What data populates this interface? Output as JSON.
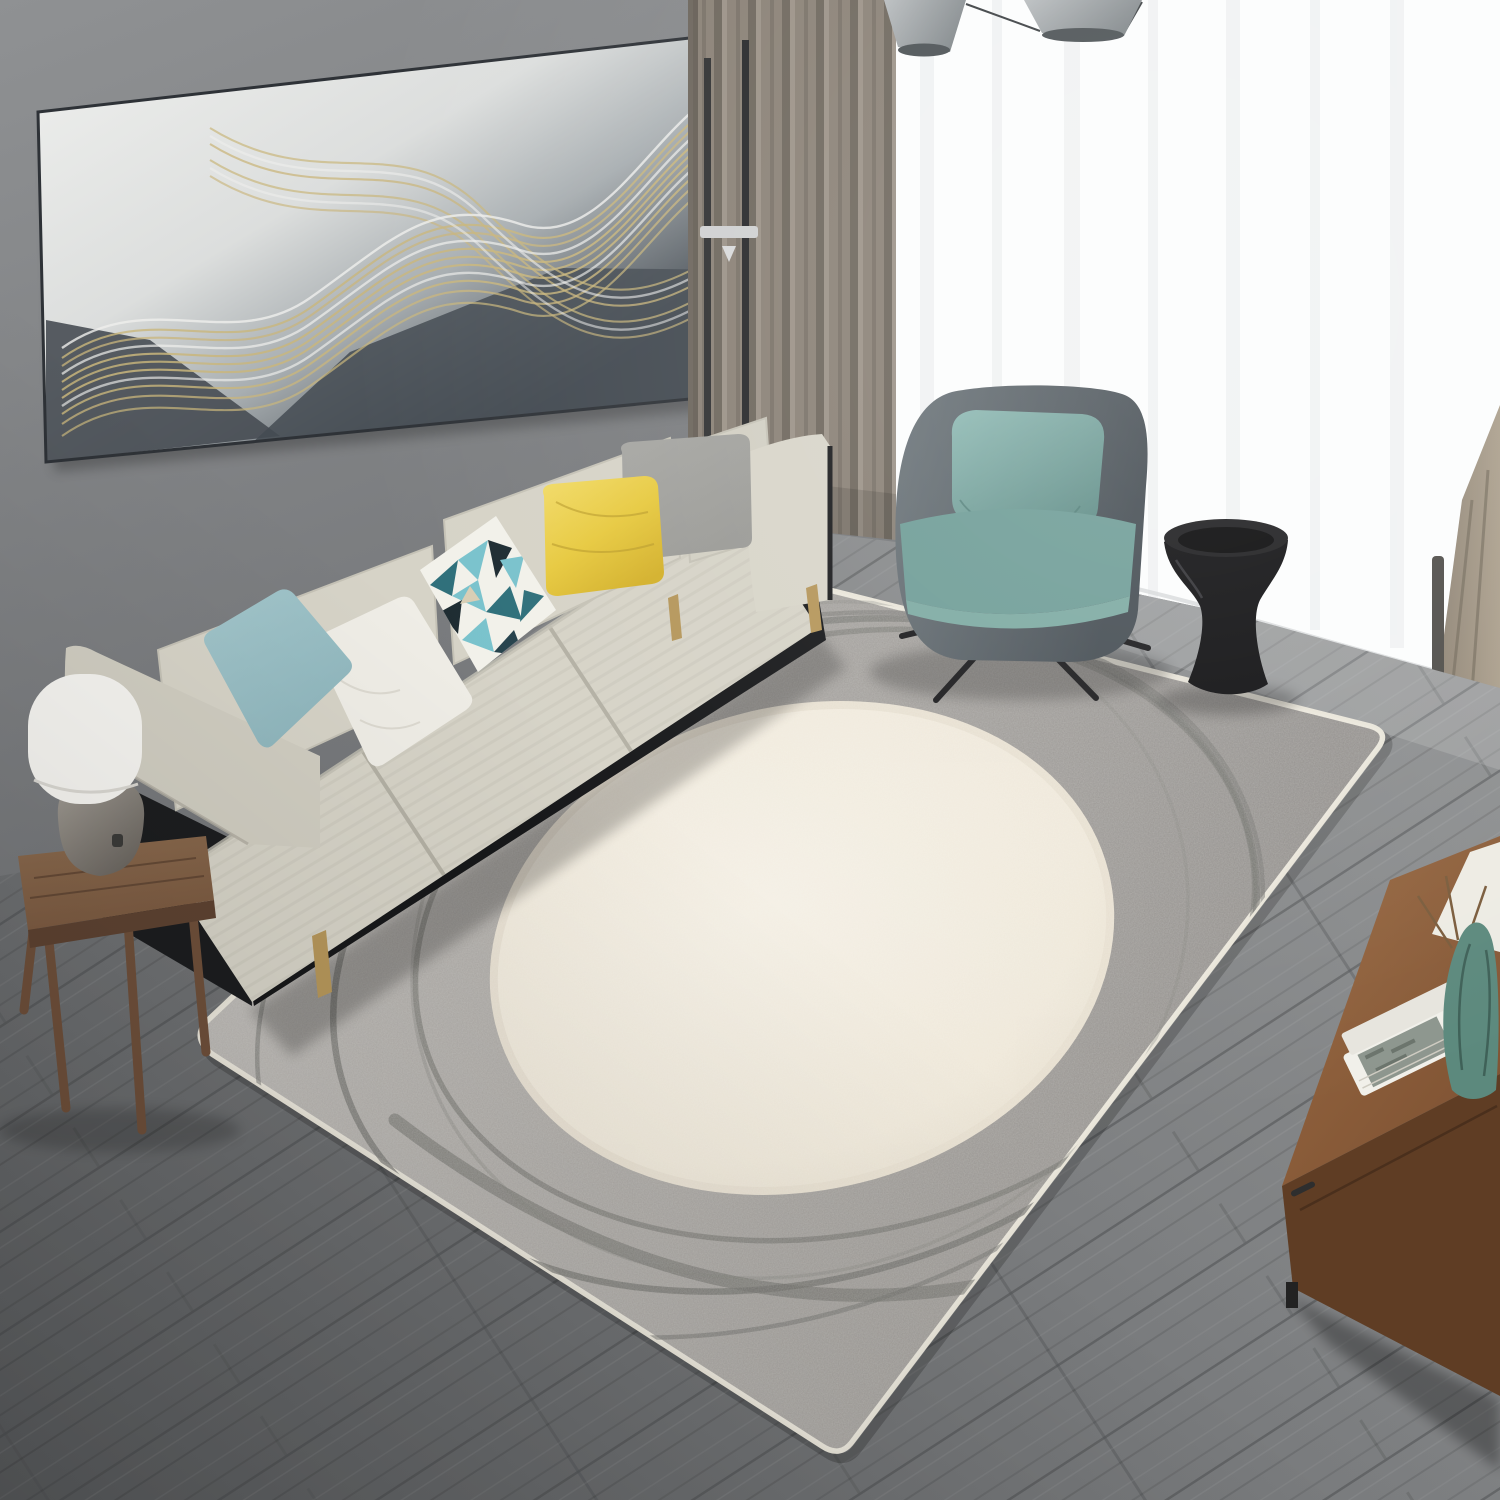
{
  "meta": {
    "title": "Living room photograph with gray and cream abstract circle area rug",
    "media_type": "photograph",
    "no_visible_text": true
  },
  "colors": {
    "wall_top": "#8f9193",
    "wall_bottom": "#6a6c6f",
    "window_white": "#fcfdfd",
    "sheer_fold": "#e7eaeb",
    "curtain_base": "#8a8176",
    "curtain_fold_dark": "#6e675d",
    "curtain_fold_light": "#9b9287",
    "curtain_right": "#ab9f8c",
    "pendant_shade": "#b9bdbf",
    "pendant_rim": "#4a5053",
    "art_light": "#eff0ee",
    "art_mid": "#a8aeb1",
    "art_dark": "#41484f",
    "art_gold": "#c9b67c",
    "art_silver": "#efefec",
    "floor_light": "#8e9091",
    "floor_dark": "#595b5d",
    "floor_seam": "#46484a",
    "rug_light": "#b7b4b0",
    "rug_mid": "#a09d99",
    "rug_dark": "#8d8a87",
    "rug_binding": "#e9e5d9",
    "rug_ring": "#6f6f6b",
    "rug_oval_center": "#f6f1e6",
    "rug_oval_edge": "#e4dccb",
    "sofa_beige": "#d6d3c7",
    "sofa_beige_dark": "#b4b1a5",
    "sofa_frame_black": "#17181a",
    "sofa_leg_gold": "#b5965a",
    "pillow_teal": "#8fb6bd",
    "pillow_white": "#efede6",
    "pillow_geo_base": "#f2f1ea",
    "pillow_geo_teal": "#79c2cc",
    "pillow_geo_dark_teal": "#2e6f7a",
    "pillow_geo_black": "#1d2b31",
    "pillow_yellow": "#e7c93f",
    "pillow_yellow_light": "#f2dc6a",
    "pillow_gray": "#9a9a96",
    "armchair_shell_light": "#6e777c",
    "armchair_shell_dark": "#454d53",
    "armchair_teal": "#6f9d97",
    "armchair_pillow_teal": "#8fbab4",
    "armchair_leg": "#1a1a1c",
    "side_table_black": "#0e0e10",
    "stool_wood": "#7b5a41",
    "stool_wood_dark": "#5d4231",
    "lamp_shade": "#f5f4f0",
    "lamp_base": "#8e8a84",
    "cabinet_top": "#9a6a42",
    "cabinet_front": "#5f3d24",
    "book_white": "#f1f0ea",
    "book_cover_art": "#8d968e",
    "sculpture_green": "#5c897d",
    "board_white": "#edebe3"
  },
  "scene": {
    "room": "modern living room",
    "objects": [
      {
        "name": "wall-art",
        "desc": "panoramic abstract canvas, silver to charcoal with gold wavy contour lines"
      },
      {
        "name": "curtain-left",
        "desc": "floor-length taupe-gray pleated curtain"
      },
      {
        "name": "window-sheer",
        "desc": "bright window with white sheer curtains"
      },
      {
        "name": "curtain-right",
        "desc": "tan curtain bottom at right edge"
      },
      {
        "name": "pendant-lights",
        "desc": "two gray cone pendant shades at ceiling"
      },
      {
        "name": "sofa",
        "desc": "beige three-seat sofa, black base frame, gold legs"
      },
      {
        "name": "sofa-pillows",
        "desc": "teal, white, teal geometric-triangle, yellow satin, gray velvet"
      },
      {
        "name": "floor-lamp",
        "desc": "thin black pole lamp behind sofa arm"
      },
      {
        "name": "armchair",
        "desc": "charcoal shell armchair with teal cushion and pillow, black splayed legs"
      },
      {
        "name": "side-table",
        "desc": "black hourglass stool table"
      },
      {
        "name": "rug",
        "desc": "large gray rug, cream off-center oval, dark scribble rings, cream binding"
      },
      {
        "name": "stool-with-lamp",
        "desc": "rustic wood stool holding white dome table lamp"
      },
      {
        "name": "tv-cabinet",
        "desc": "walnut cabinet with white books, green sculpture, leaning white board"
      },
      {
        "name": "floor",
        "desc": "gray wash wood plank floor laid diagonally"
      }
    ]
  }
}
